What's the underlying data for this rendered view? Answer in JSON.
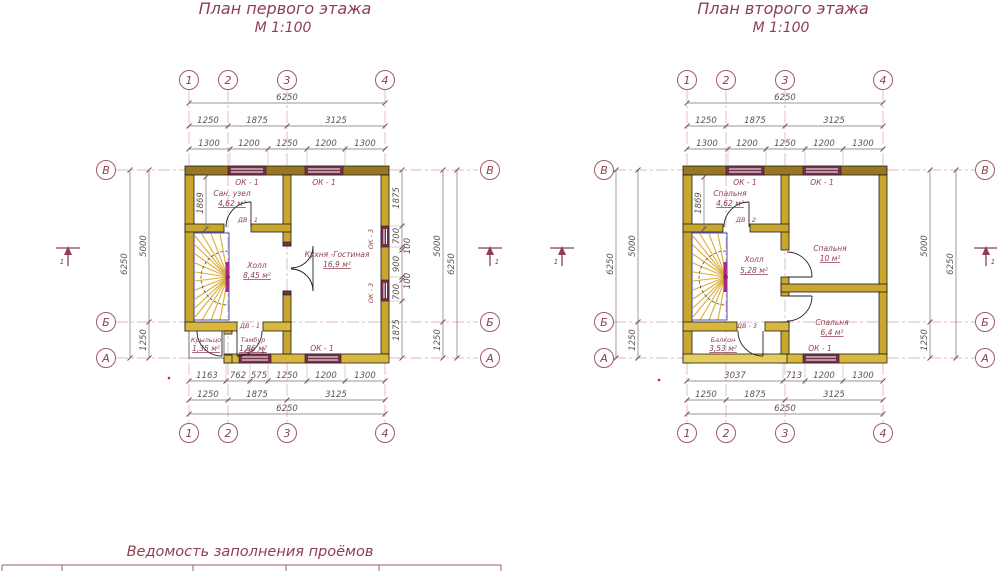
{
  "plan1": {
    "title": "План первого этажа",
    "scale": "М 1:100",
    "grid_cols": [
      "1",
      "2",
      "3",
      "4"
    ],
    "grid_rows": [
      "В",
      "Б",
      "А"
    ],
    "dim_total": "6250",
    "top_row2": [
      "1250",
      "1875",
      "3125"
    ],
    "top_row3": [
      "1300",
      "1200",
      "1250",
      "1200",
      "1300"
    ],
    "bottom_row1": [
      "1163",
      "762",
      "575",
      "1250",
      "1200",
      "1300"
    ],
    "bottom_row2": [
      "1250",
      "1875",
      "3125"
    ],
    "side_segments": [
      "5000",
      "1250"
    ],
    "right_detail": [
      "1875",
      "700",
      "100",
      "900",
      "100",
      "700",
      "1875"
    ],
    "stair_dim": "1869",
    "section_label": "1",
    "rooms": {
      "sanuzel": {
        "name": "Сан. узел",
        "area": "4,62 м²"
      },
      "kitchen": {
        "name": "Кухня -Гостиная",
        "area": "16,9 м²"
      },
      "hall": {
        "name": "Холл",
        "area": "8,45 м²"
      },
      "porch": {
        "name": "Крыльцо",
        "area": "1,35 м²"
      },
      "tambour": {
        "name": "Тамбур",
        "area": "1,86 м²"
      }
    },
    "openings": {
      "ok1": "ОК - 1",
      "ok2": "ОК - 2",
      "ok3": "ОК - 3",
      "dv1": "ДВ - 1"
    }
  },
  "plan2": {
    "title": "План второго этажа",
    "scale": "М 1:100",
    "grid_cols": [
      "1",
      "2",
      "3",
      "4"
    ],
    "grid_rows": [
      "В",
      "Б",
      "А"
    ],
    "dim_total": "6250",
    "top_row2": [
      "1250",
      "1875",
      "3125"
    ],
    "top_row3": [
      "1300",
      "1200",
      "1250",
      "1200",
      "1300"
    ],
    "bottom_row1": [
      "3037",
      "713",
      "1200",
      "1300"
    ],
    "bottom_row2": [
      "1250",
      "1875",
      "3125"
    ],
    "side_segments": [
      "5000",
      "1250"
    ],
    "stair_dim": "1869",
    "section_label": "1",
    "rooms": {
      "bedroom1": {
        "name": "Спальня",
        "area": "4,62 м²"
      },
      "bedroom2": {
        "name": "Спальня",
        "area": "10 м²"
      },
      "bedroom3": {
        "name": "Спальня",
        "area": "6,4 м²"
      },
      "hall": {
        "name": "Холл",
        "area": "5,28 м²"
      },
      "balcony": {
        "name": "Балкон",
        "area": "3,53 м²"
      }
    },
    "openings": {
      "ok1": "ОК - 1",
      "dv2": "ДВ - 2",
      "dv3": "ДВ - 3"
    }
  },
  "schedule": {
    "title": "Ведомость заполнения проёмов"
  }
}
